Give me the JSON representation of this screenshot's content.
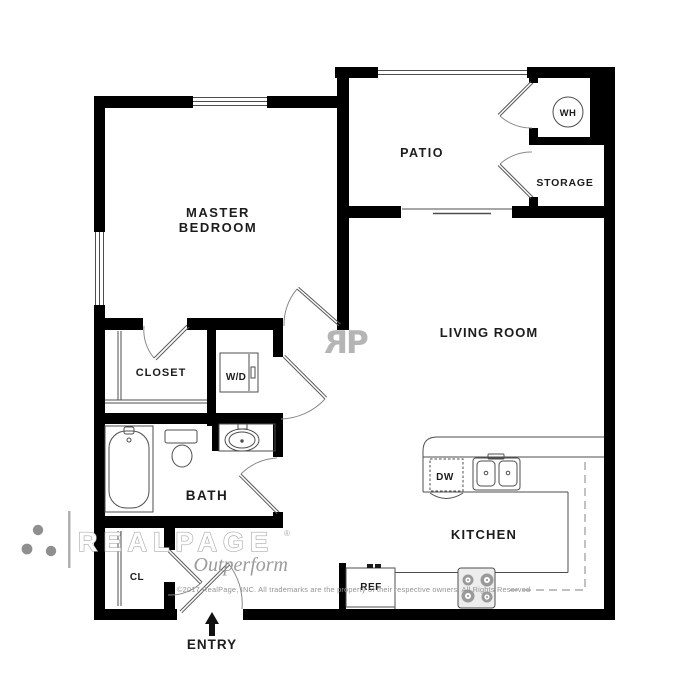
{
  "rooms": {
    "master_bedroom": {
      "line1": "MASTER",
      "line2": "BEDROOM"
    },
    "patio": "PATIO",
    "storage": "STORAGE",
    "water_heater": "WH",
    "living_room": "LIVING ROOM",
    "closet": "CLOSET",
    "washer_dryer": "W/D",
    "bath": "BATH",
    "hall_closet": "CL",
    "kitchen": "KITCHEN",
    "entry": "ENTRY"
  },
  "appliances": {
    "dishwasher": "DW",
    "refrigerator": "REF"
  },
  "watermark": {
    "brand": "REALPAGE",
    "registered": "®",
    "tagline": "Outperform",
    "monogram_reversed_r": "R",
    "monogram_p": "P",
    "copyright": "©2017 RealPage, INC.  All trademarks are the property of their respective owners.  All Rights Reserved"
  },
  "colors": {
    "wall": "#000000",
    "fixture_line": "#4d4d4d",
    "door_arc": "#8a8a8a",
    "watermark_gray": "#ababab",
    "logo_dot_gray": "#8f8f8f"
  }
}
